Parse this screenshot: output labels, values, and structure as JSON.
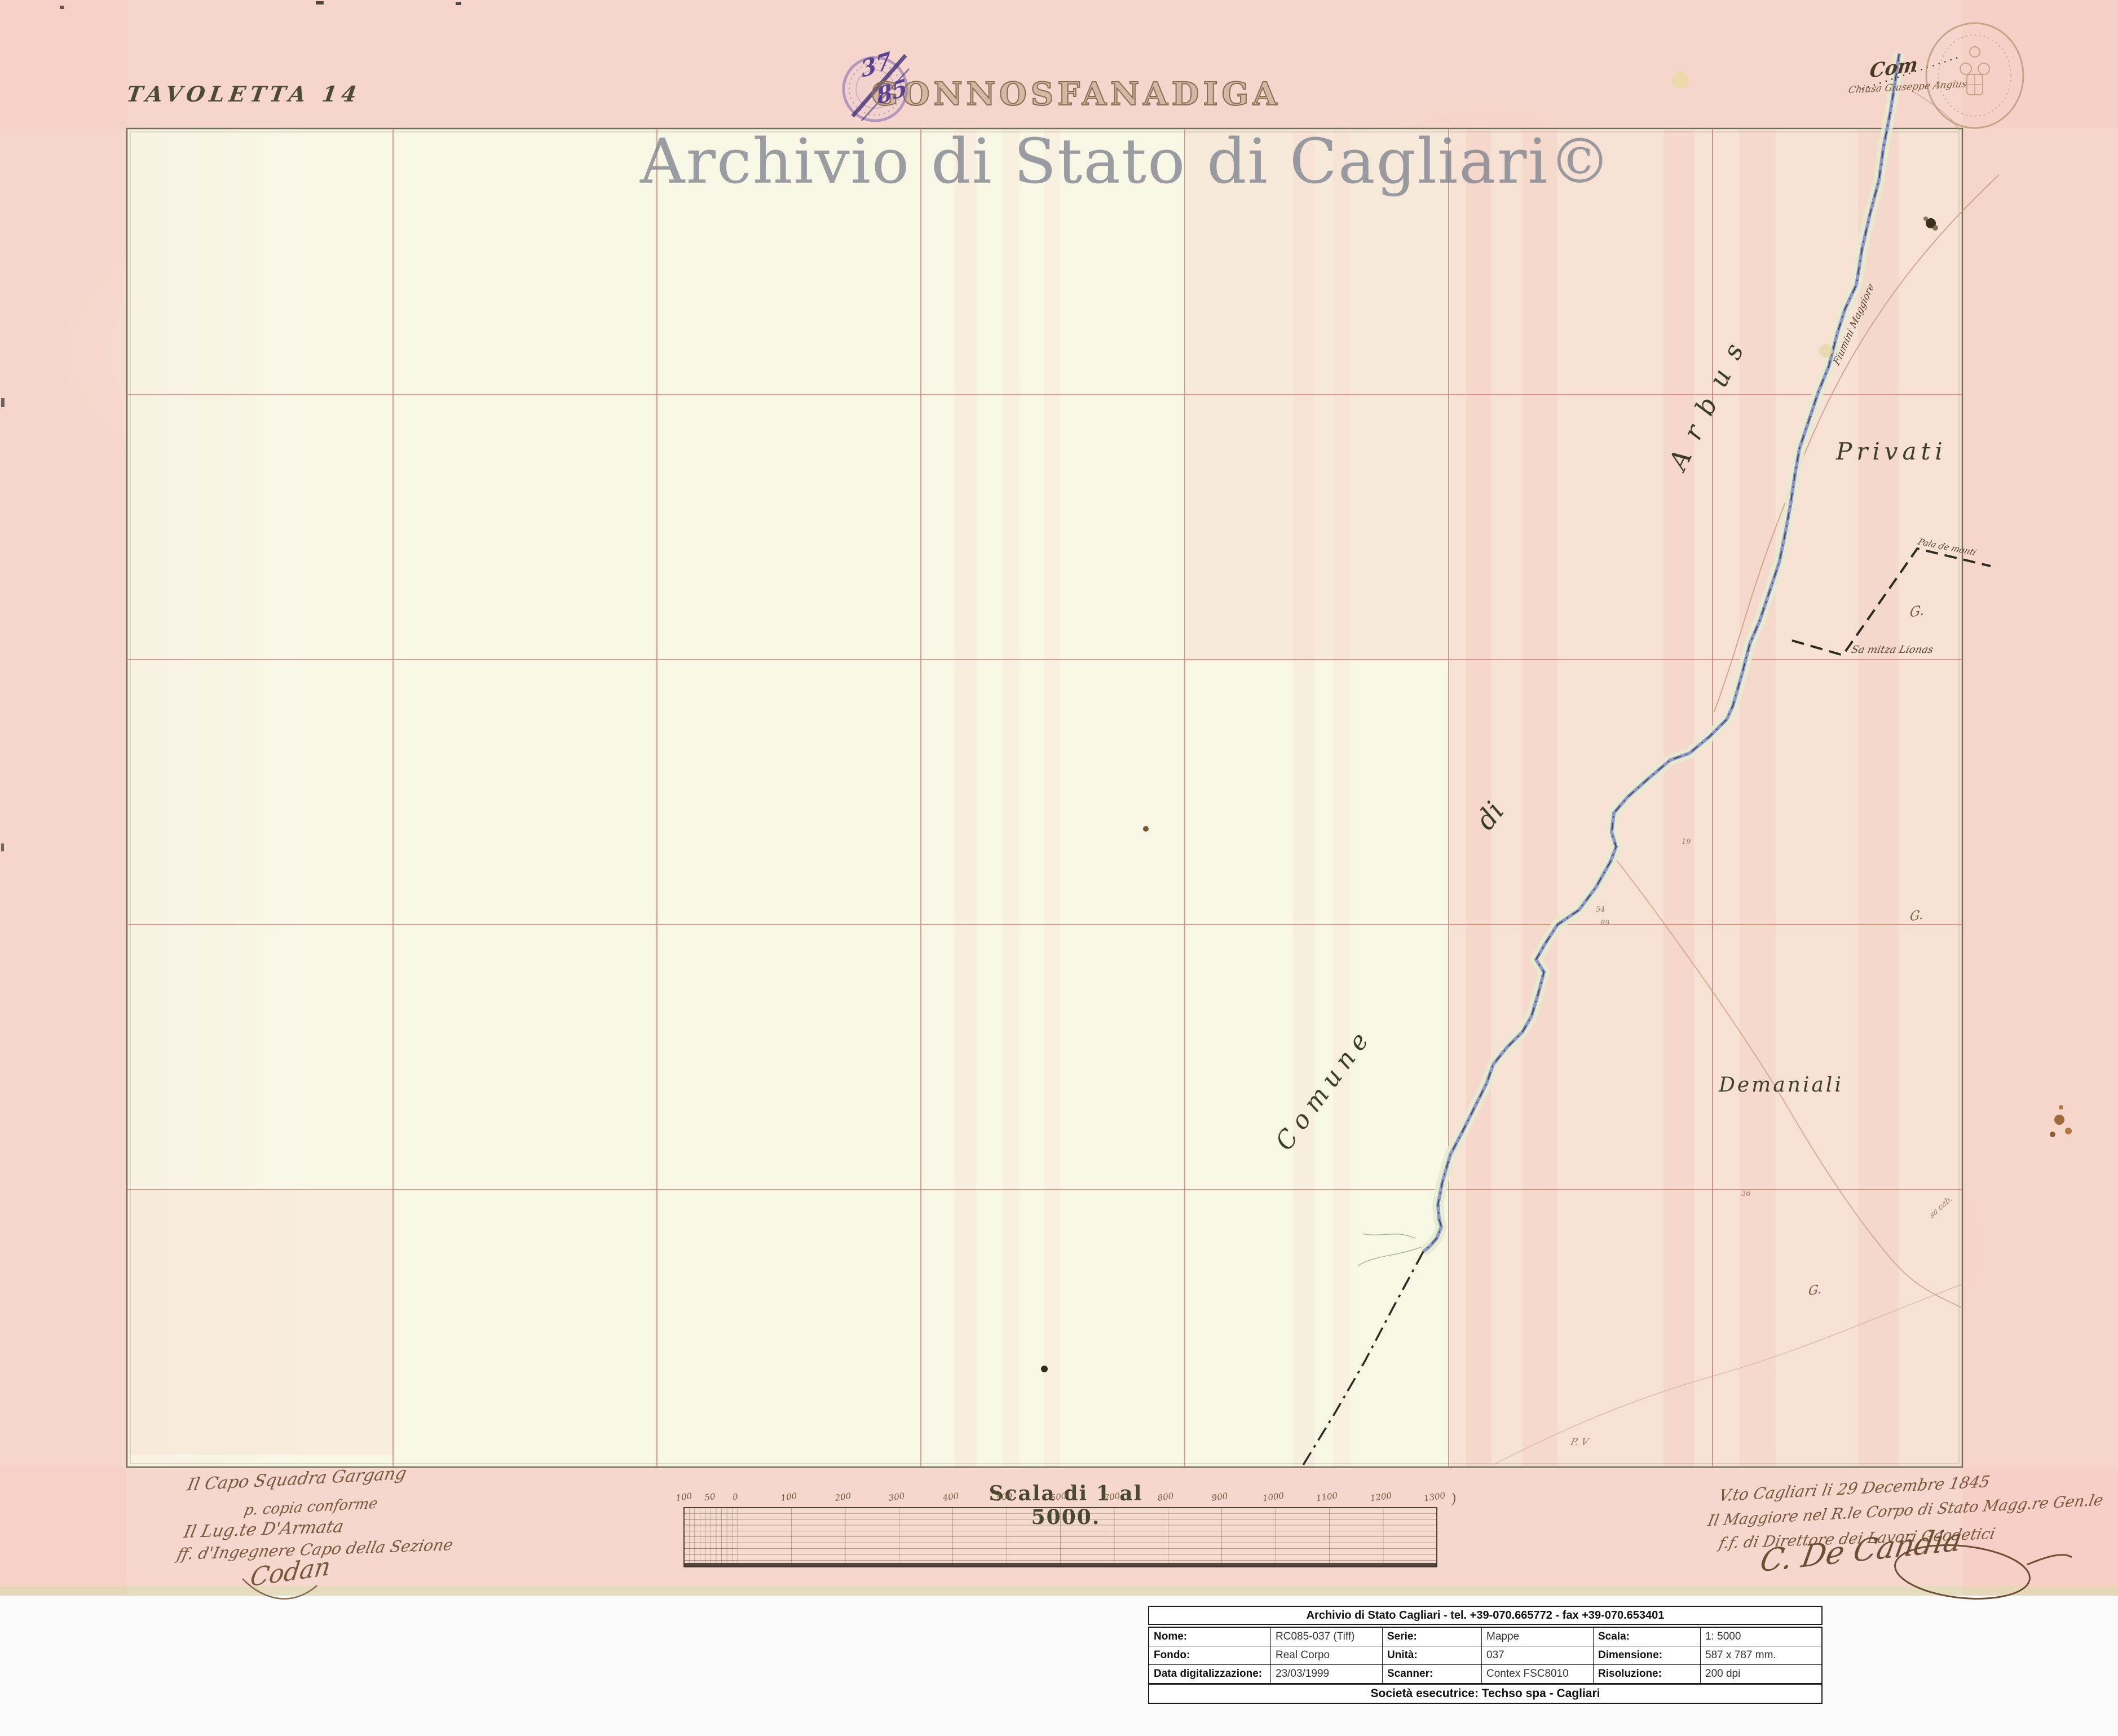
{
  "header": {
    "tavoletta": "TAVOLETTA 14",
    "title": "GONNOSFANADIGA",
    "watermark": "Archivio di Stato di Cagliari©",
    "stamp_top": "37",
    "stamp_bottom": "85"
  },
  "labels": {
    "com": "Com",
    "chiusa": "Chiusa Giuseppe Angius",
    "road": "Fiumini Maggiore",
    "arbus": "Arbus",
    "privati": "Privati",
    "di": "di",
    "comune": "Comune",
    "demaniali": "Demaniali",
    "samitza": "Sa mitza Lionas",
    "pala": "Pala de monti",
    "g": "G.",
    "pv": "P. V",
    "n19": "19",
    "n54": "54",
    "n89": "89",
    "n36": "36",
    "sacab": "sa cab."
  },
  "scale": {
    "title": "Scala di 1 al 5000.",
    "ticks": [
      "100",
      "50",
      "0",
      "100",
      "200",
      "300",
      "400",
      "500",
      "600",
      "700",
      "800",
      "900",
      "1000",
      "1100",
      "1200",
      "1300"
    ],
    "paren": ")"
  },
  "notes_left": {
    "line1": "Il Capo Squadra Gargang",
    "line2": "p. copia conforme",
    "line3": "Il Lug.te D'Armata",
    "line4": "ff. d'Ingegnere Capo della Sezione",
    "signature": "Codan"
  },
  "notes_right": {
    "line1": "V.to Cagliari li 29 Decembre 1845",
    "line2": "Il Maggiore nel R.le Corpo di Stato Magg.re Gen.le",
    "line3": "f.f. di Direttore dei Lavori Geodetici",
    "signature": "C. De Candia"
  },
  "info_table": {
    "header": "Archivio di Stato Cagliari - tel. +39-070.665772 - fax +39-070.653401",
    "rows": [
      [
        {
          "label": "Nome:",
          "value": "RC085-037 (Tiff)"
        },
        {
          "label": "Serie:",
          "value": "Mappe"
        },
        {
          "label": "Scala:",
          "value": "1: 5000"
        }
      ],
      [
        {
          "label": "Fondo:",
          "value": "Real Corpo"
        },
        {
          "label": "Unità:",
          "value": "037"
        },
        {
          "label": "Dimensione:",
          "value": "587 x 787 mm."
        }
      ],
      [
        {
          "label": "Data digitalizzazione:",
          "value": "23/03/1999"
        },
        {
          "label": "Scanner:",
          "value": "Contex FSC8010"
        },
        {
          "label": "Risoluzione:",
          "value": "200 dpi"
        }
      ]
    ],
    "footer": "Società esecutrice: Techso spa - Cagliari"
  },
  "colors": {
    "paper_pink": "#f7ded4",
    "sheet_cream": "#f8f7e6",
    "grid_red": "#c96f62",
    "river_blue": "#8d93c4",
    "ink_sepia": "#7a573a",
    "stamp_purple": "#7e64b2",
    "title_brown": "#8a6e52",
    "watermark_gray": "#7d848e"
  }
}
